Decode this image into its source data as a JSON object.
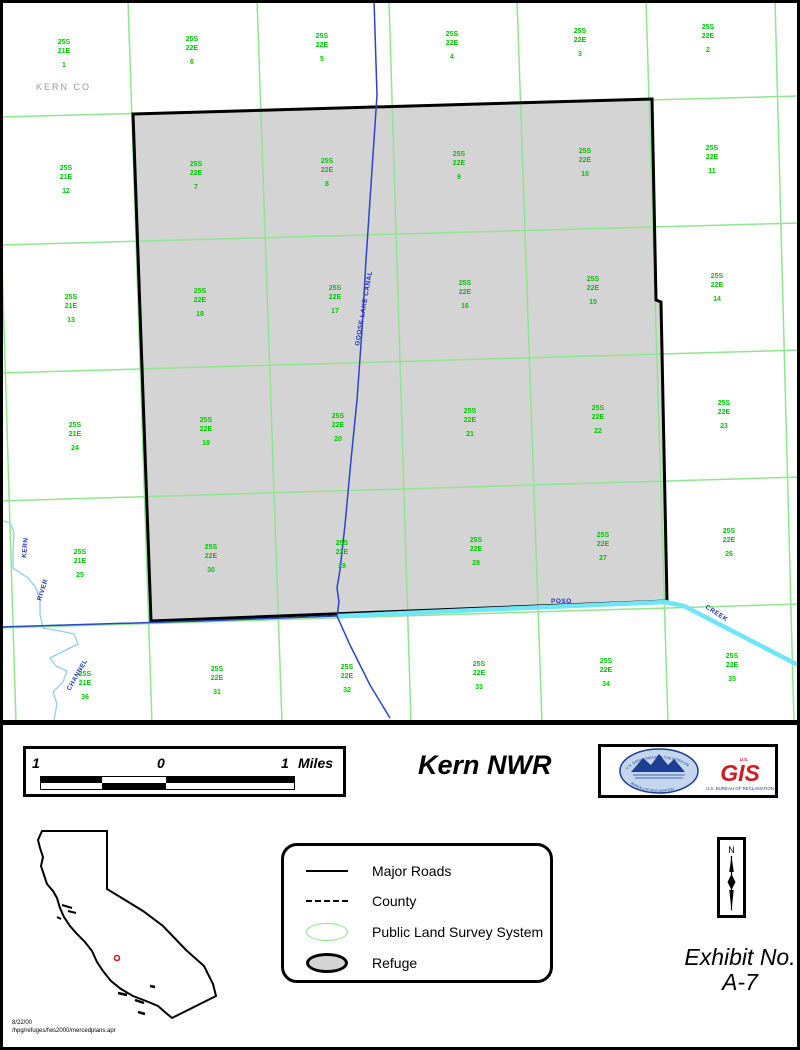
{
  "map": {
    "county_label": "KERN CO",
    "canal_label": "GOOSE LAKE CANAL",
    "kern_label": "KERN",
    "river_label": "RIVER",
    "channel_label": "CHANNEL",
    "poso_label": "POSO",
    "creek_label": "CREEK",
    "sections": [
      {
        "t": "25S",
        "r": "21E",
        "n": "1",
        "x": 64,
        "y": 44
      },
      {
        "t": "25S",
        "r": "22E",
        "n": "6",
        "x": 192,
        "y": 41
      },
      {
        "t": "25S",
        "r": "22E",
        "n": "5",
        "x": 322,
        "y": 38
      },
      {
        "t": "25S",
        "r": "22E",
        "n": "4",
        "x": 452,
        "y": 36
      },
      {
        "t": "25S",
        "r": "22E",
        "n": "3",
        "x": 580,
        "y": 33
      },
      {
        "t": "25S",
        "r": "22E",
        "n": "2",
        "x": 708,
        "y": 29
      },
      {
        "t": "25S",
        "r": "21E",
        "n": "12",
        "x": 66,
        "y": 170
      },
      {
        "t": "25S",
        "r": "22E",
        "n": "7",
        "x": 196,
        "y": 166
      },
      {
        "t": "25S",
        "r": "22E",
        "n": "8",
        "x": 327,
        "y": 163
      },
      {
        "t": "25S",
        "r": "22E",
        "n": "9",
        "x": 459,
        "y": 156
      },
      {
        "t": "25S",
        "r": "22E",
        "n": "10",
        "x": 585,
        "y": 153
      },
      {
        "t": "25S",
        "r": "22E",
        "n": "11",
        "x": 712,
        "y": 150
      },
      {
        "t": "25S",
        "r": "21E",
        "n": "13",
        "x": 71,
        "y": 299
      },
      {
        "t": "25S",
        "r": "22E",
        "n": "18",
        "x": 200,
        "y": 293
      },
      {
        "t": "25S",
        "r": "22E",
        "n": "17",
        "x": 335,
        "y": 290
      },
      {
        "t": "25S",
        "r": "22E",
        "n": "16",
        "x": 465,
        "y": 285
      },
      {
        "t": "25S",
        "r": "22E",
        "n": "15",
        "x": 593,
        "y": 281
      },
      {
        "t": "25S",
        "r": "22E",
        "n": "14",
        "x": 717,
        "y": 278
      },
      {
        "t": "25S",
        "r": "21E",
        "n": "24",
        "x": 75,
        "y": 427
      },
      {
        "t": "25S",
        "r": "22E",
        "n": "19",
        "x": 206,
        "y": 422
      },
      {
        "t": "25S",
        "r": "22E",
        "n": "20",
        "x": 338,
        "y": 418
      },
      {
        "t": "25S",
        "r": "22E",
        "n": "21",
        "x": 470,
        "y": 413
      },
      {
        "t": "25S",
        "r": "22E",
        "n": "22",
        "x": 598,
        "y": 410
      },
      {
        "t": "25S",
        "r": "22E",
        "n": "23",
        "x": 724,
        "y": 405
      },
      {
        "t": "25S",
        "r": "21E",
        "n": "25",
        "x": 80,
        "y": 554
      },
      {
        "t": "25S",
        "r": "22E",
        "n": "30",
        "x": 211,
        "y": 549
      },
      {
        "t": "25S",
        "r": "22E",
        "n": "29",
        "x": 342,
        "y": 545
      },
      {
        "t": "25S",
        "r": "22E",
        "n": "28",
        "x": 476,
        "y": 542
      },
      {
        "t": "25S",
        "r": "22E",
        "n": "27",
        "x": 603,
        "y": 537
      },
      {
        "t": "25S",
        "r": "22E",
        "n": "26",
        "x": 729,
        "y": 533
      },
      {
        "t": "25S",
        "r": "21E",
        "n": "36",
        "x": 85,
        "y": 676
      },
      {
        "t": "25S",
        "r": "22E",
        "n": "31",
        "x": 217,
        "y": 671
      },
      {
        "t": "25S",
        "r": "22E",
        "n": "32",
        "x": 347,
        "y": 669
      },
      {
        "t": "25S",
        "r": "22E",
        "n": "33",
        "x": 479,
        "y": 666
      },
      {
        "t": "25S",
        "r": "22E",
        "n": "34",
        "x": 606,
        "y": 663
      },
      {
        "t": "25S",
        "r": "22E",
        "n": "35",
        "x": 732,
        "y": 658
      }
    ]
  },
  "scalebar": {
    "left_value": "1",
    "center_value": "0",
    "right_value": "1",
    "units": "Miles"
  },
  "title": "Kern NWR",
  "logos": {
    "doi_seal_top": "U.S. DEPARTMENT OF THE INTERIOR",
    "doi_seal_bottom": "BUREAU OF RECLAMATION",
    "gis_us": "U.S.",
    "gis_text": "GIS",
    "gis_caption": "U.S. BUREAU OF RECLAMATION"
  },
  "legend": {
    "items": [
      {
        "label": "Major Roads"
      },
      {
        "label": "County"
      },
      {
        "label": "Public Land Survey System"
      },
      {
        "label": "Refuge"
      }
    ]
  },
  "north_label": "N",
  "exhibit": {
    "line1": "Exhibit No.",
    "line2": "A-7"
  },
  "footnote": {
    "date": "8/22/00",
    "path": "/hpg/refuges/fws2000/mercedplans.apr"
  },
  "colors": {
    "grid_green": "#8fe78f",
    "section_green": "#00c800",
    "canal_blue": "#2946c8",
    "river_blue": "#8fd0e8",
    "poso_cyan": "#6ee6f5",
    "refuge_gray": "#d4d4d4",
    "county_gray": "#9a9a9a",
    "marker_red": "#cc2222",
    "seal_navy": "#1e3f91",
    "gis_red": "#cc1f1f"
  }
}
